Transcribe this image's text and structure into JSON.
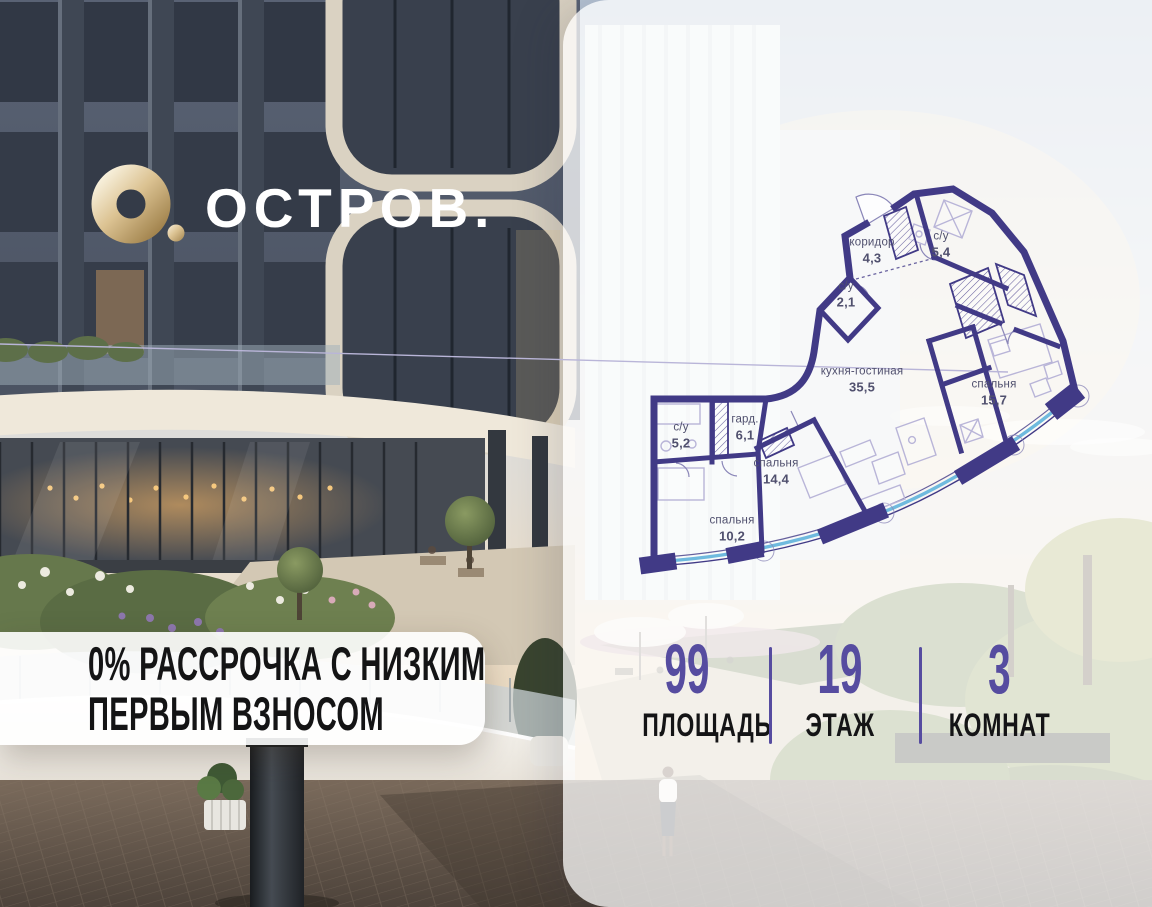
{
  "brand": {
    "wordmark": "ОСТРОВ.",
    "logo_icon": "gold-ring-with-dot-icon",
    "gold_color": "#c9a76a"
  },
  "offer": {
    "line1": "0% РАССРОЧКА С НИЗКИМ",
    "line2": "ПЕРВЫМ ВЗНОСОМ"
  },
  "stats": {
    "accent_color": "#564ca0",
    "items": [
      {
        "value": "99",
        "label": "ПЛОЩАДЬ"
      },
      {
        "value": "19",
        "label": "ЭТАЖ"
      },
      {
        "value": "3",
        "label": "КОМНАТ"
      }
    ]
  },
  "floor_plan": {
    "wall_color": "#413a86",
    "window_color": "#6fbade",
    "label_color": "#50506e",
    "rooms": [
      {
        "name": "коридор",
        "area": "4,3"
      },
      {
        "name": "с/у",
        "area": "5,4"
      },
      {
        "name": "с/у",
        "area": "2,1"
      },
      {
        "name": "кухня-гостиная",
        "area": "35,5"
      },
      {
        "name": "спальня",
        "area": "15,7"
      },
      {
        "name": "с/у",
        "area": "5,2"
      },
      {
        "name": "гард.",
        "area": "6,1"
      },
      {
        "name": "спальня",
        "area": "14,4"
      },
      {
        "name": "спальня",
        "area": "10,2"
      }
    ]
  }
}
